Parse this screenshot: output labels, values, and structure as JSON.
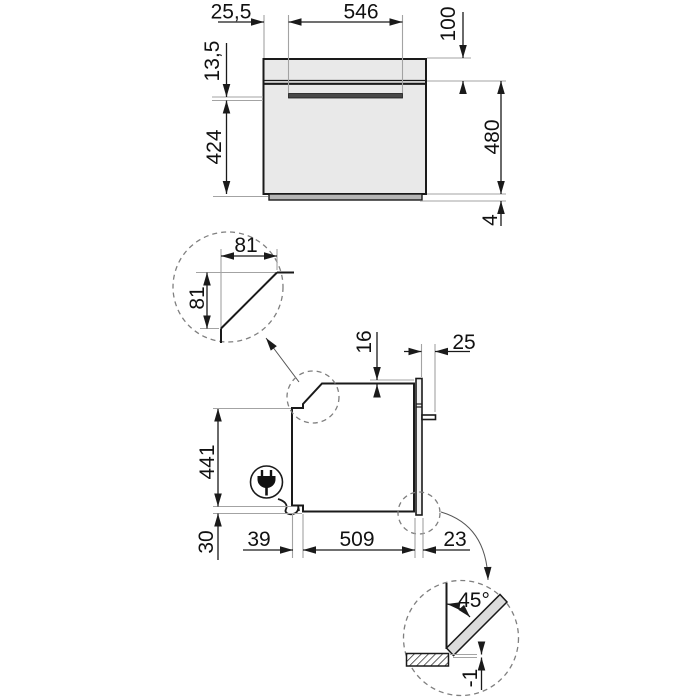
{
  "drawing": {
    "front_view": {
      "offset_left": "25,5",
      "handle_width": "546",
      "panel_height": "100",
      "handle_offset": "13,5",
      "door_height": "424",
      "niche_height": "480",
      "base_clearance": "4"
    },
    "corner_detail": {
      "cut_width": "81",
      "cut_height": "81"
    },
    "side_view": {
      "top_clearance": "16",
      "handle_depth": "25",
      "body_height": "441",
      "bottom_clearance": "30",
      "front_clearance": "39",
      "body_depth": "509",
      "door_thickness": "23"
    },
    "door_detail": {
      "opening_angle": "45°",
      "floor_clearance": "-1"
    }
  }
}
